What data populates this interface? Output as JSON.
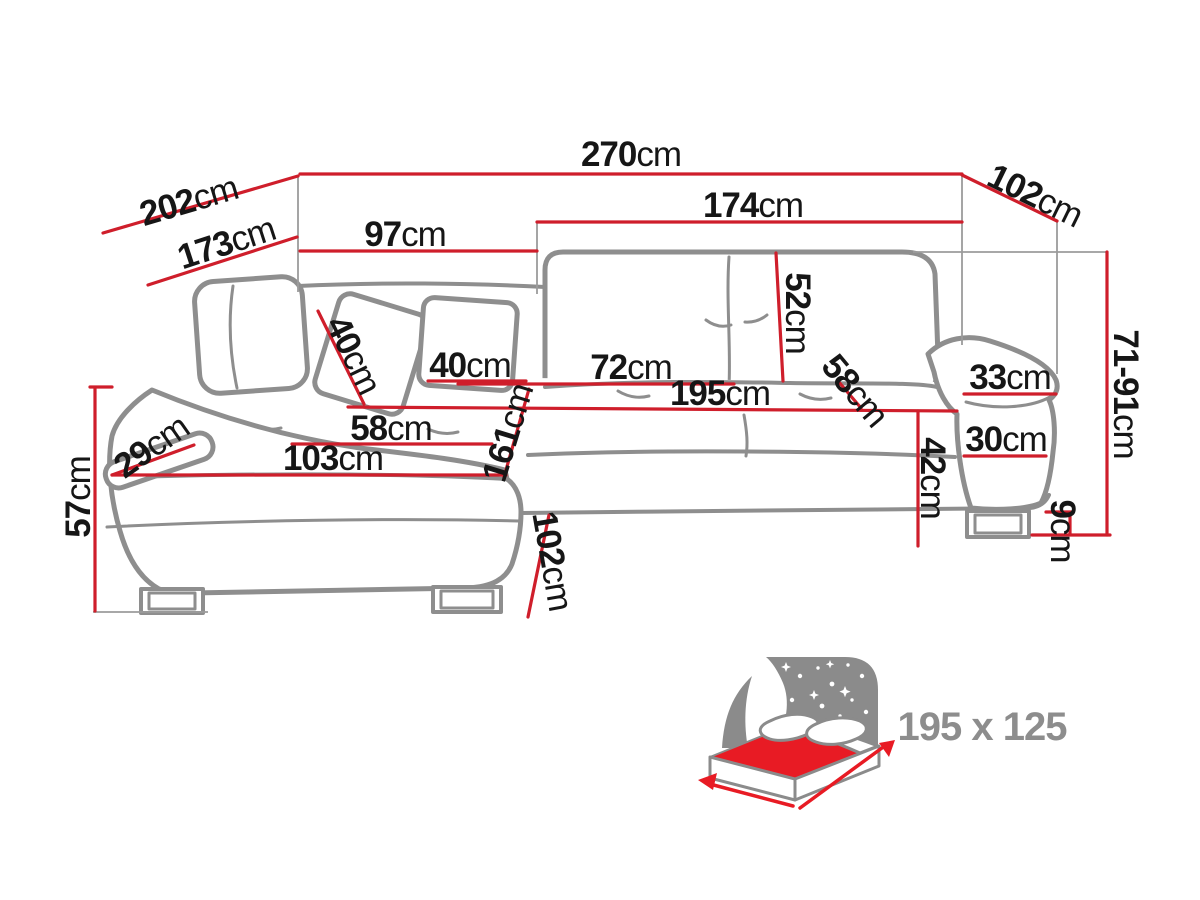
{
  "diagram": {
    "type": "corner-sofa-dimension-drawing",
    "unit": "cm"
  },
  "colors": {
    "dimension_line": "#cf1e2b",
    "sofa_outline": "#8e8e8e",
    "label_text": "#161616",
    "bed_icon_gray": "#8b8b8b",
    "bed_mattress_red": "#e81b24"
  },
  "dims": {
    "d270": {
      "v": "270",
      "u": "cm"
    },
    "d202": {
      "v": "202",
      "u": "cm"
    },
    "d173": {
      "v": "173",
      "u": "cm"
    },
    "d97": {
      "v": "97",
      "u": "cm"
    },
    "d174": {
      "v": "174",
      "u": "cm"
    },
    "d102_side": {
      "v": "102",
      "u": "cm"
    },
    "d52": {
      "v": "52",
      "u": "cm"
    },
    "d40_pillow_left": {
      "v": "40",
      "u": "cm"
    },
    "d40_pillow_right": {
      "v": "40",
      "u": "cm"
    },
    "d72": {
      "v": "72",
      "u": "cm"
    },
    "d195": {
      "v": "195",
      "u": "cm"
    },
    "d58_seat_right": {
      "v": "58",
      "u": "cm"
    },
    "d33": {
      "v": "33",
      "u": "cm"
    },
    "d30": {
      "v": "30",
      "u": "cm"
    },
    "d42": {
      "v": "42",
      "u": "cm"
    },
    "d71_91": {
      "v": "71-91",
      "u": "cm"
    },
    "d9": {
      "v": "9",
      "u": "cm"
    },
    "d29": {
      "v": "29",
      "u": "cm"
    },
    "d58_seat_left": {
      "v": "58",
      "u": "cm"
    },
    "d103": {
      "v": "103",
      "u": "cm"
    },
    "d161": {
      "v": "161",
      "u": "cm"
    },
    "d102_front": {
      "v": "102",
      "u": "cm"
    },
    "d57": {
      "v": "57",
      "u": "cm"
    }
  },
  "bed_icon": {
    "caption": "195 x 125"
  }
}
